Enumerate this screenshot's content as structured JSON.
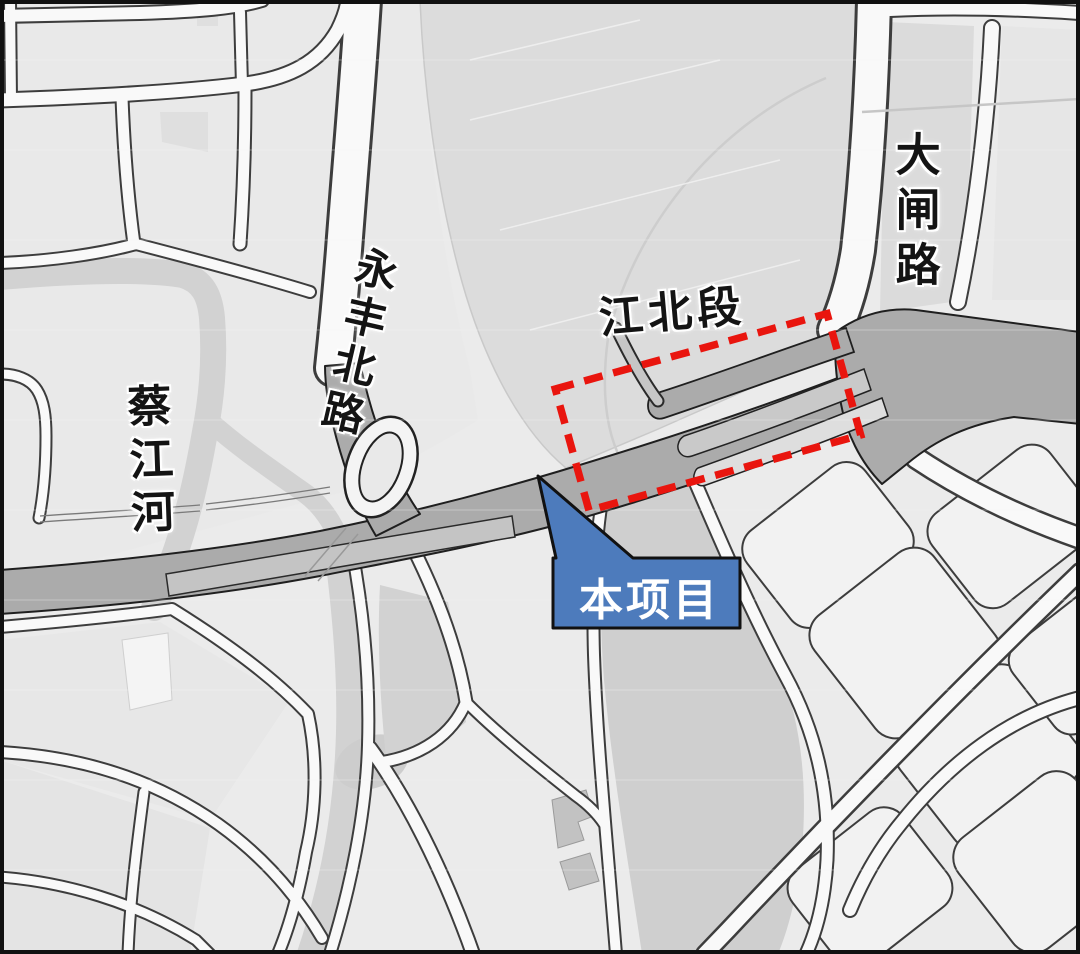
{
  "map": {
    "title": "project-location-map",
    "labels": {
      "river": "蔡江河",
      "road_north": "永丰北路",
      "section": "江北段",
      "road_east": "大闸路",
      "callout": "本项目"
    },
    "colors": {
      "highlight_red": "#e9150e",
      "callout_blue": "#4d7bbc",
      "callout_text": "#ffffff",
      "road_major_fill": "#ababab",
      "road_minor_fill": "#f9f9f9",
      "water_fill": "#cfcfcf",
      "label_text": "#141414"
    }
  }
}
